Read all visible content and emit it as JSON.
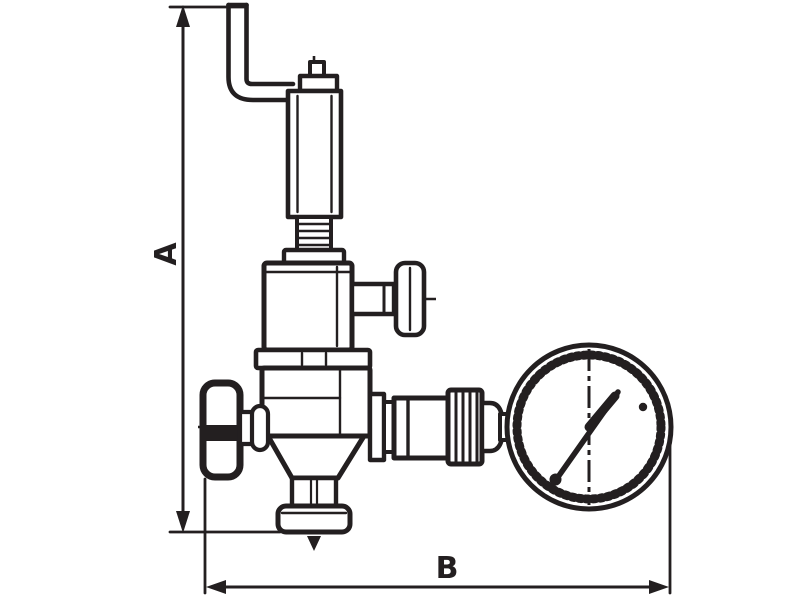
{
  "diagram": {
    "kind": "technical-drawing",
    "subject": "pressure reducing valve with relief pipe, handwheel and pressure gauge (side view)",
    "background_color": "#ffffff",
    "line_color": "#231f20",
    "dimensions": {
      "vertical": {
        "label": "A"
      },
      "horizontal": {
        "label": "B"
      }
    },
    "parts": [
      "relief-discharge-pipe",
      "adjusting-screw",
      "spring-housing",
      "bonnet",
      "side-t-handle",
      "valve-body",
      "handwheel",
      "bottom-outlet-flange",
      "union-fitting",
      "pressure-gauge"
    ]
  }
}
